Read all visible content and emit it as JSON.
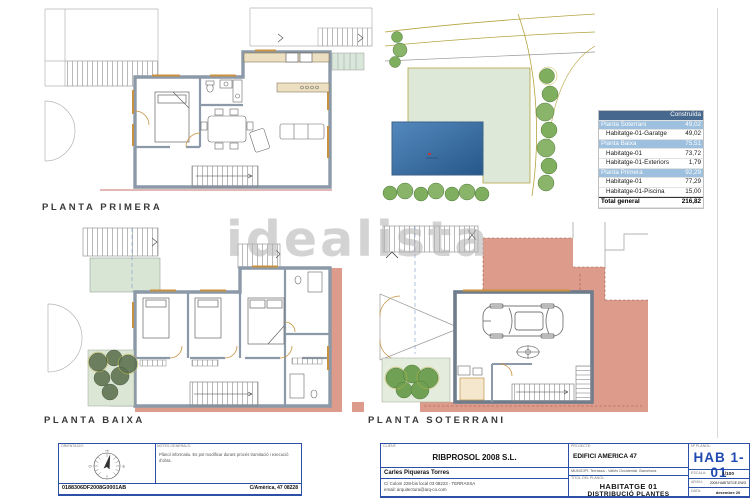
{
  "watermark": "idealista",
  "plans": {
    "primera_label": "PLANTA PRIMERA",
    "baixa_label": "PLANTA BAIXA",
    "soterrani_label": "PLANTA SOTERRANI"
  },
  "area_table": {
    "header": "Construïda",
    "rows": [
      {
        "label": "Planta Soterrani",
        "value": "49,02",
        "type": "group"
      },
      {
        "label": "Habitatge-01-Garatge",
        "value": "49,02",
        "type": "detail"
      },
      {
        "label": "Planta Baixa",
        "value": "75,51",
        "type": "group"
      },
      {
        "label": "Habitatge-01",
        "value": "73,72",
        "type": "detail"
      },
      {
        "label": "Habitatge-01-Exteriors",
        "value": "1,79",
        "type": "detail"
      },
      {
        "label": "Planta Primera",
        "value": "92,29",
        "type": "group"
      },
      {
        "label": "Habitatge-01",
        "value": "77,29",
        "type": "detail"
      },
      {
        "label": "Habitatge-01-Piscina",
        "value": "15,00",
        "type": "detail"
      },
      {
        "label": "Total general",
        "value": "216,82",
        "type": "total"
      }
    ]
  },
  "title_block": {
    "orientation_label": "ORIENTACIÓ:",
    "compass": {
      "n": "N",
      "s": "S",
      "e": "E",
      "o": "O"
    },
    "notes_label": "NOTES GENERALS:",
    "notes": "Plànol informatiu. Es pot modificar durant procés tramitació i execució d'obra.",
    "ref_number": "0188306DF2008G0001AB",
    "site_address": "C/Amèrica, 47 08228",
    "client_label": "CLIENT:",
    "client": "RIBPROSOL 2008 S.L.",
    "architect": "Carles Piqueras Torres",
    "architect_address": "C/ Colom 228-bis local 03   08223 - TERRASSA",
    "architect_email": "email: arquitectura@arq-co.com",
    "project_label": "PROJECTE:",
    "project": "EDIFICI AMERICA 47",
    "municipality": "MUNICIPI:   Terrassa - Vallès Occidental, Barcelona",
    "sheet_title_label": "TÍTOL DEL PLÀNOL:",
    "sheet_title_1": "HABITATGE 01",
    "sheet_title_2": "DISTRIBUCIÓ PLANTES",
    "sheet_number_label": "Nº PLÀNOL:",
    "sheet_number": "HAB 1- 01",
    "scale_label": "ESCALA:",
    "scale": "1/100",
    "file_label": "ARXIU:",
    "file": "2008.HABITATGE.DWG",
    "date_label": "DATA:",
    "date": "desembre 20"
  },
  "colors": {
    "wall": "#8b99a9",
    "door": "#c8913f",
    "salmon": "#dc9b8b",
    "pale_green": "#dde8d8",
    "pool_blue": "#2a5c90",
    "table_header_blue": "#47688e",
    "table_group_blue": "#9dc0de",
    "titleblock_blue": "#2b50a5",
    "sheet_number_blue": "#1f49b0",
    "boundary_olive": "#b3a43f"
  }
}
